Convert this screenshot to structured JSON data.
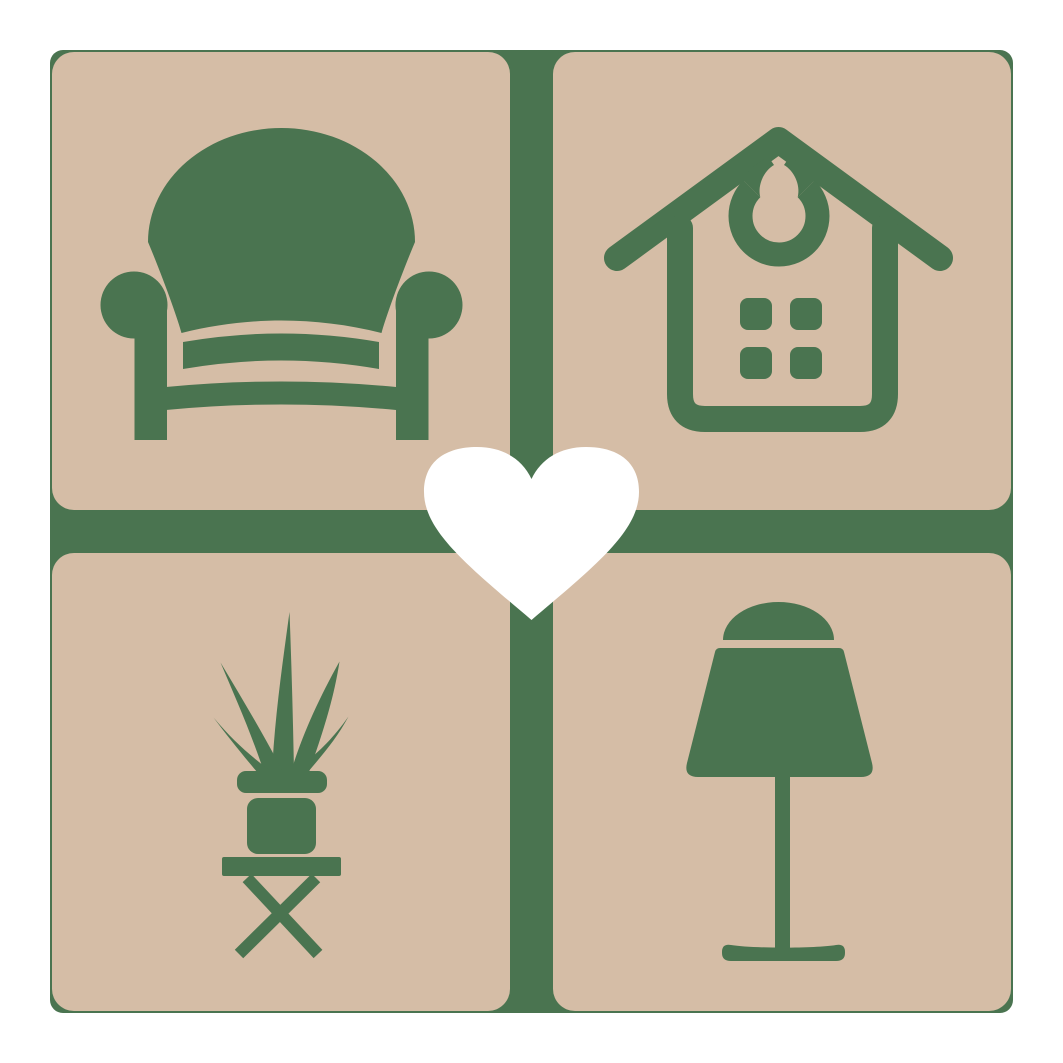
{
  "image_type": "logo-graphic",
  "logo": {
    "name": "home-decor-heart-logo",
    "colors": {
      "green": "#4a7450",
      "tan": "#d5bda6",
      "heart": "#ffffff",
      "page_background": "#ffffff"
    },
    "grid": {
      "rows": 2,
      "cols": 2
    },
    "tiles": [
      {
        "position": "top-left",
        "icon": "armchair-icon"
      },
      {
        "position": "top-right",
        "icon": "house-icon"
      },
      {
        "position": "bottom-left",
        "icon": "potted-plant-stool-icon"
      },
      {
        "position": "bottom-right",
        "icon": "table-lamp-icon"
      }
    ],
    "center_icon": "heart-icon"
  }
}
